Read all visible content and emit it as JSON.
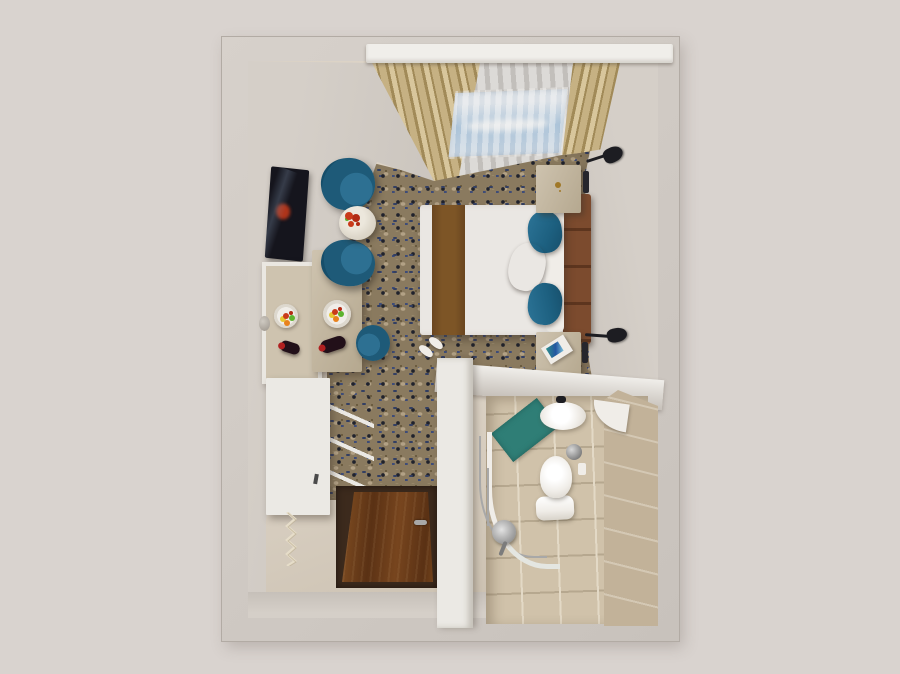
{
  "scene": {
    "type": "3d-top-down-interior-render",
    "description": "Top-down dollhouse render of a hotel guest room: bedroom with double bed, lounge chairs and desk along the left wall, entry corridor with wooden door at bottom-left, en-suite bathroom at bottom-right, window wall with drapes and sheers at top.",
    "rooms": [
      "bedroom",
      "entry-corridor",
      "bathroom"
    ],
    "objects": [
      "window-pelmet",
      "tan-drapes",
      "sheer-curtains",
      "sky-through-window",
      "double-bed",
      "white-duvet",
      "brown-bed-runner",
      "upholstered-headboard",
      "blue-pillows",
      "cream-pillow",
      "nightstand-left",
      "nightstand-right",
      "room-keys",
      "magazine",
      "wall-reading-lamps",
      "wall-niches",
      "teal-tub-armchair-1",
      "teal-tub-armchair-2",
      "round-marble-side-table",
      "red-flower-centerpiece",
      "wall-mounted-tv",
      "framed-mirror",
      "travertine-desk",
      "fruit-plate",
      "wine-bottle",
      "teal-desk-chair",
      "white-dresser",
      "open-shelf-rails",
      "coat-hook-rack",
      "door-knob",
      "wooden-entry-door",
      "door-handle",
      "white-slippers",
      "patterned-carpet",
      "tile-floor",
      "bathroom-partition-wall",
      "bathroom-tiled-floor",
      "washbasin",
      "faucet",
      "corner-shelf",
      "teal-bath-mat",
      "toilet",
      "trash-bin",
      "toilet-paper-holder",
      "curved-shower-rail",
      "shower-slide-rail",
      "shower-head"
    ]
  },
  "colors": {
    "background": "#d9d3cf",
    "frame_wall": "#c8c2bc",
    "frame_wall_light": "#d7d1cb",
    "frame_edge": "#b2aba4",
    "wall_face": "#d5cfc8",
    "wall_face_dark": "#c6c0b9",
    "floor_beige": "#dcd3c6",
    "floor_shadow": "#c7bcab",
    "carpet_base": "#8a7a5f",
    "carpet_navy": "#333f63",
    "carpet_navy2": "#3e4c78",
    "carpet_dark": "#20222c",
    "carpet_light": "#b2a185",
    "carpet_mid": "#6b5c40",
    "carpet_tan": "#9c8c6d",
    "pelmet": "#f0eeea",
    "drape_tan": "#c6b183",
    "drape_tan_dark": "#a18a58",
    "drape_tan_light": "#d8c69c",
    "sheer_light": "#dcdad7",
    "sheer_dark": "#c2bfbb",
    "sky_blue": "#a9c9e6",
    "sky_light": "#e6eef7",
    "duvet": "#eae7e3",
    "duvet_shadow": "#d5d1cc",
    "runner": "#7d5526",
    "runner_dark": "#6a4620",
    "headboard": "#7c4b2e",
    "headboard_dark": "#5d351e",
    "pillow_blue": "#1d6080",
    "pillow_blue_light": "#2d7598",
    "pillow_blue_dark": "#164e6a",
    "pillow_cream": "#ecdcae",
    "teal_chair": "#1e5a78",
    "teal_chair_light": "#2d7092",
    "table_marble": "#ded8cb",
    "flower_red": "#c93a1a",
    "fruit_red2": "#b22b14",
    "fruit_green": "#5db32e",
    "fruit_orange": "#e8821e",
    "fruit_yellow": "#e6c832",
    "tv_dark": "#15151d",
    "travertine": "#cec3af",
    "travertine_dark": "#b5a88f",
    "mirror_frame": "#eae7e1",
    "white_furn": "#ebe9e4",
    "white_fix": "#f0ede8",
    "wood_door": "#77451e",
    "wood_door_dark": "#5a3114",
    "recess_dark": "#3c2a1d",
    "bath_tile": "#d0c2aa",
    "bath_tile_dark": "#c2b299",
    "bath_grout": "#e3d9c6",
    "mat_teal": "#2f7e76",
    "mat_teal_dark": "#23605a",
    "chrome": "#a8a8a8",
    "chrome_dark": "#7c7c7c",
    "black_metal": "#1d1d22",
    "slot_dark": "#26262c",
    "keys_amber": "#a07828",
    "wine_bottle": "#221019",
    "wine_cap": "#b02020",
    "knob_light": "#cfcac2",
    "knob_dark": "#9a938a"
  }
}
